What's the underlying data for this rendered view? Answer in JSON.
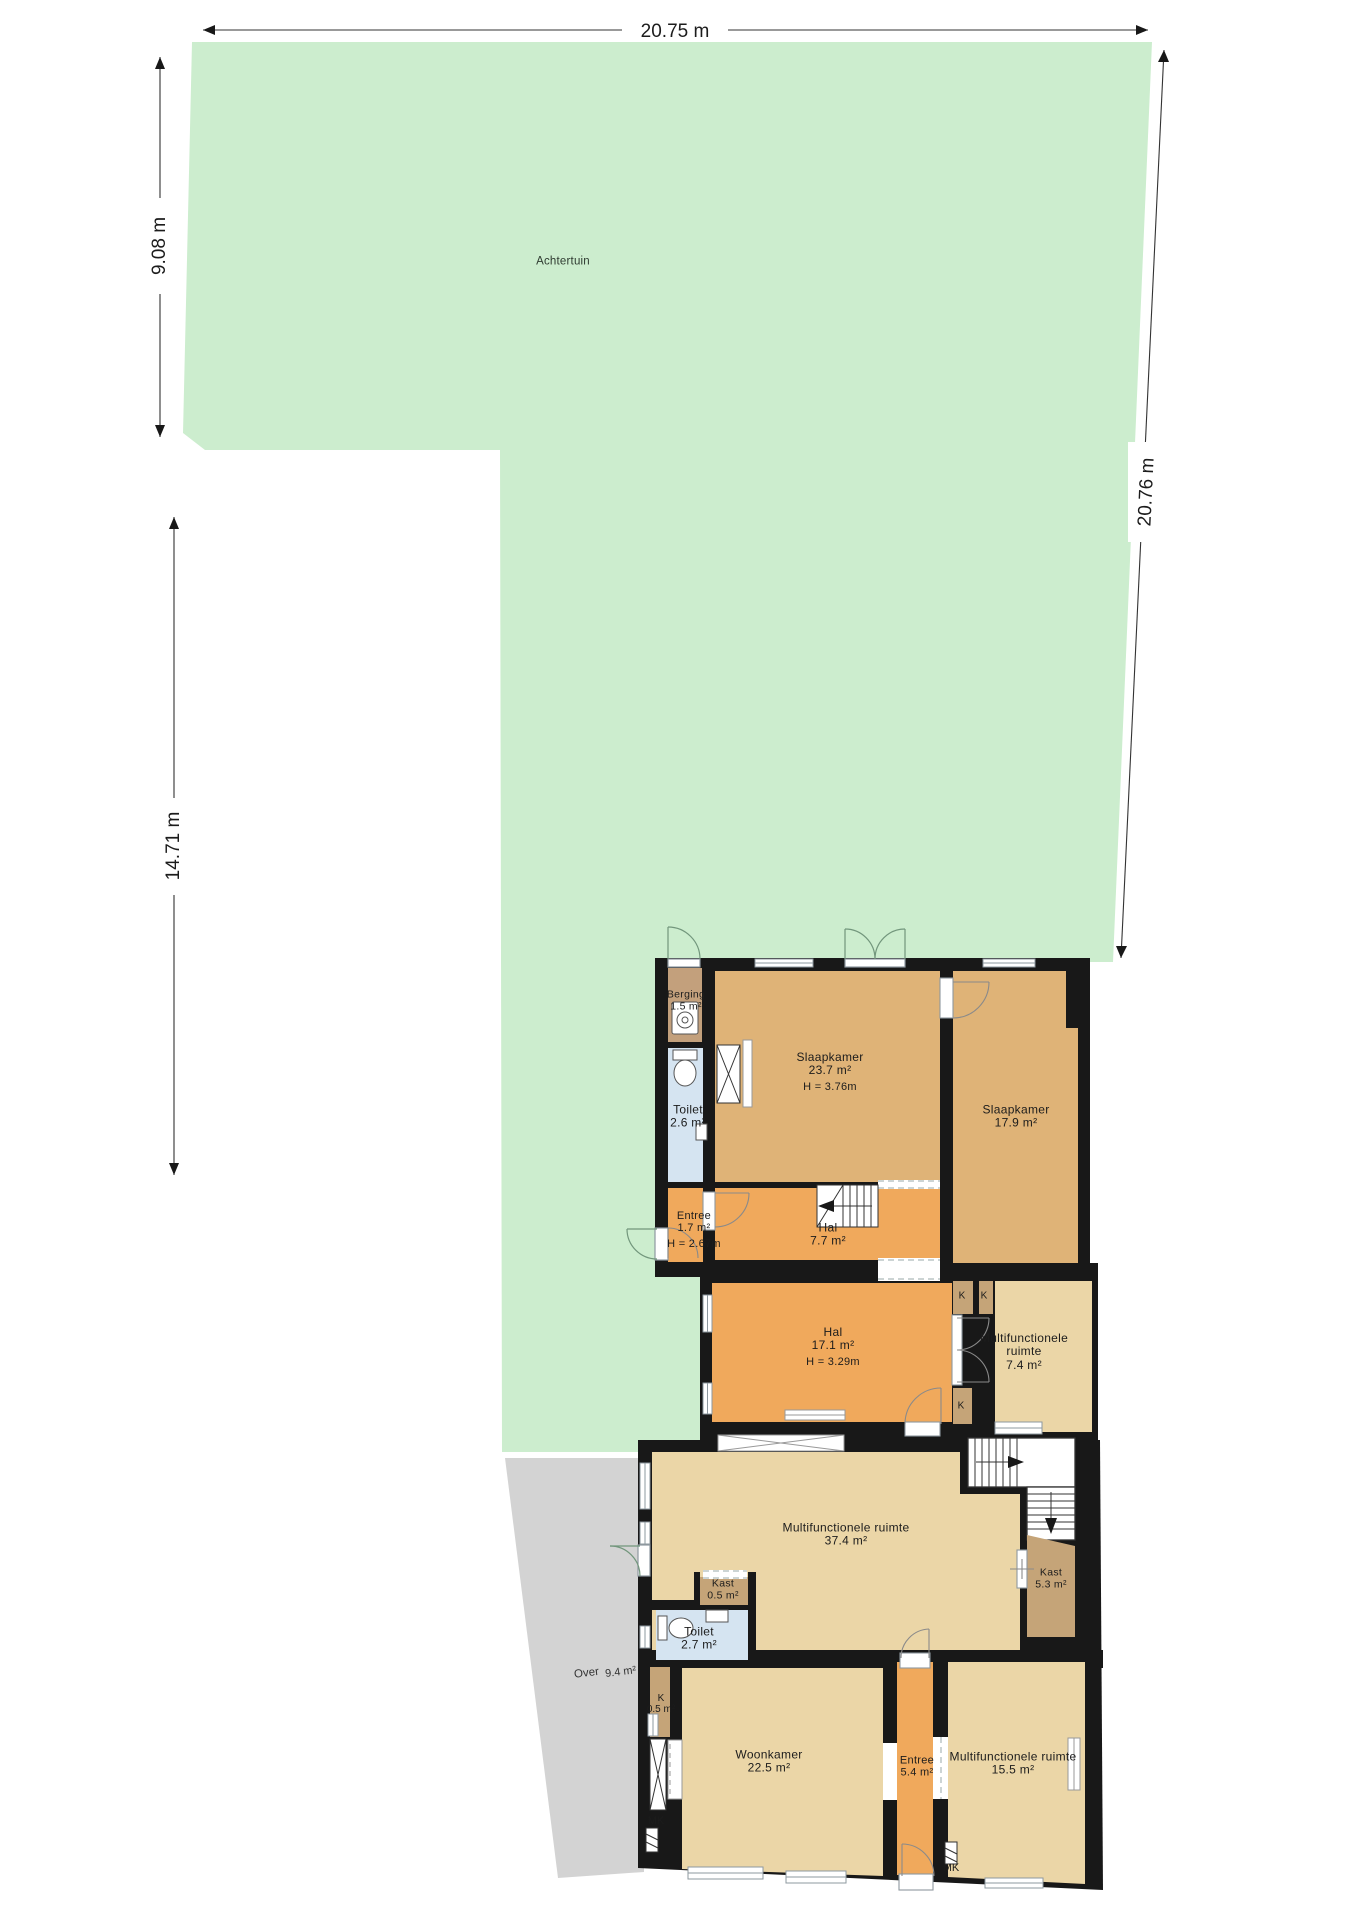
{
  "dimensions": {
    "top": "20.75 m",
    "left_upper": "9.08 m",
    "left_lower": "14.71 m",
    "right": "20.76 m"
  },
  "areas": {
    "garden": {
      "label": "Achtertuin"
    },
    "over": {
      "label": "Over",
      "area": "9.4 m²"
    }
  },
  "rooms": [
    {
      "name": "Berging",
      "area": "1.5 m²"
    },
    {
      "name": "Toilet",
      "area": "2.6 m²"
    },
    {
      "name": "Slaapkamer",
      "area": "23.7 m²",
      "height": "H = 3.76m"
    },
    {
      "name": "Slaapkamer",
      "area": "17.9 m²"
    },
    {
      "name": "Entree",
      "area": "1.7 m²",
      "height": "H = 2.67m"
    },
    {
      "name": "Hal",
      "area": "7.7 m²"
    },
    {
      "name": "Hal",
      "area": "17.1 m²",
      "height": "H = 3.29m"
    },
    {
      "name": "Multifunctionele ruimte",
      "area": "7.4 m²"
    },
    {
      "name": "Multifunctionele ruimte",
      "area": "37.4 m²"
    },
    {
      "name": "Kast",
      "area": "0.5 m²"
    },
    {
      "name": "Toilet",
      "area": "2.7 m²"
    },
    {
      "name": "Kast",
      "area": "5.3 m²"
    },
    {
      "name": "K",
      "area": "0.5 m²"
    },
    {
      "name": "Woonkamer",
      "area": "22.5 m²"
    },
    {
      "name": "Entree",
      "area": "5.4 m²"
    },
    {
      "name": "Multifunctionele ruimte",
      "area": "15.5 m²"
    }
  ],
  "labels": {
    "closet": "K",
    "meter_cabinet": "MK"
  },
  "icons": [
    "washing-machine-icon",
    "toilet-icon",
    "sink-icon",
    "stairs-icon",
    "radiator-icon",
    "shaft-icon",
    "meter-cabinet-icon",
    "door-arc-icon",
    "window-icon"
  ],
  "colors": {
    "garden_green": "#ccedce",
    "over_gray": "#d3d3d3",
    "wall_black": "#181818",
    "hall_orange": "#f0a95c",
    "bedroom_tan": "#dfb377",
    "closet_brown": "#c5a478",
    "living_cream": "#ebd6a7",
    "toilet_blue": "#d5e4f1"
  }
}
